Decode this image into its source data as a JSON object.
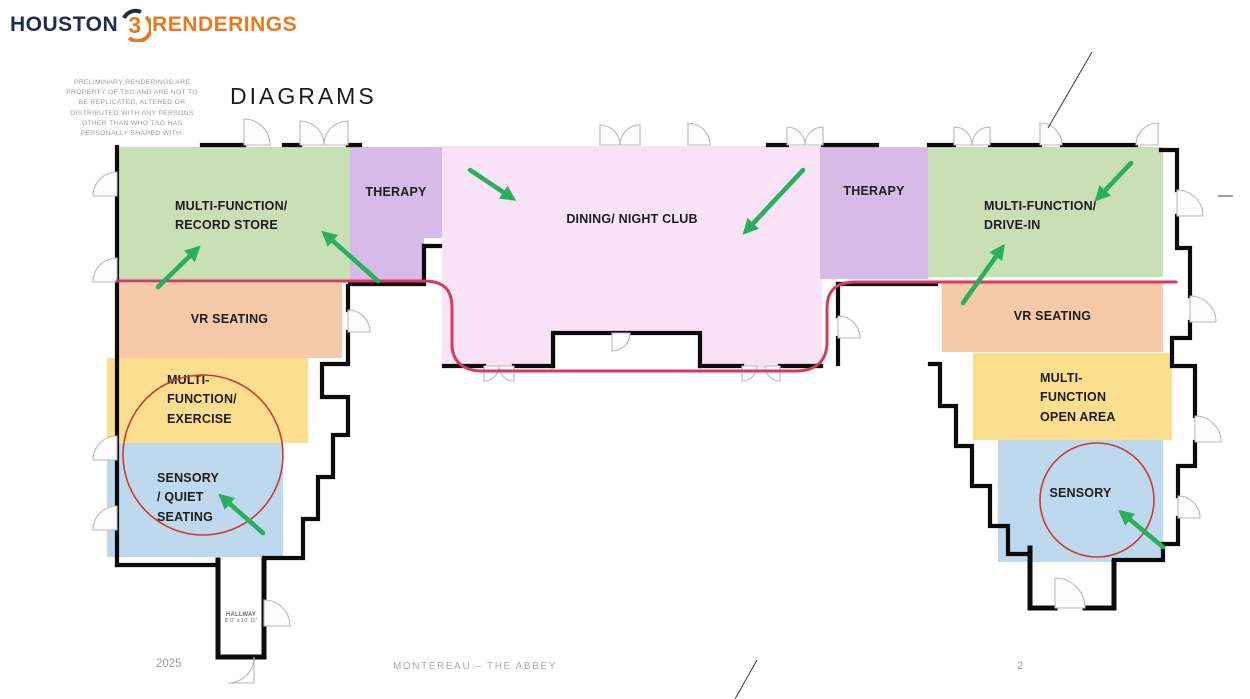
{
  "header": {
    "logo": {
      "word1": "HOUSTON",
      "digit": "3",
      "word2": "RENDERINGS",
      "navy": "#1f2c4e",
      "orange": "#e8791f"
    },
    "disclaimer": "PRELIMINARY RENDERINGS ARE\nPROPERTY OF TSG AND ARE NOT TO\nBE REPLICATED, ALTERED OR\nDISTRIBUTED WITH ANY PERSONS\nOTHER THAN WHO TSG HAS\nPERSONALLY SHARED WITH.",
    "title": "DIAGRAMS"
  },
  "zones": [
    {
      "id": "left-multifunction-record-store",
      "label": "MULTI-FUNCTION/\nRECORD STORE",
      "color": "#c9e0b6"
    },
    {
      "id": "left-therapy",
      "label": "THERAPY",
      "color": "#d6bae7"
    },
    {
      "id": "dining-night-club",
      "label": "DINING/ NIGHT CLUB",
      "color": "#f8e3f6"
    },
    {
      "id": "right-therapy",
      "label": "THERAPY",
      "color": "#d6bae7"
    },
    {
      "id": "right-multifunction-drive-in",
      "label": "MULTI-FUNCTION/\nDRIVE-IN",
      "color": "#c9e0b6"
    },
    {
      "id": "left-vr-seating",
      "label": "VR SEATING",
      "color": "#f6caa9"
    },
    {
      "id": "right-vr-seating",
      "label": "VR SEATING",
      "color": "#f6caa9"
    },
    {
      "id": "left-multifunction-exercise",
      "label": "MULTI-\nFUNCTION/\nEXERCISE",
      "color": "#fbdf8e"
    },
    {
      "id": "right-multifunction-open-area",
      "label": "MULTI-\nFUNCTION\nOPEN AREA",
      "color": "#fbdf8e"
    },
    {
      "id": "left-sensory-quiet-seating",
      "label": "SENSORY\n/ QUIET\nSEATING",
      "color": "#bed8ed"
    },
    {
      "id": "right-sensory",
      "label": "SENSORY",
      "color": "#bed8ed"
    }
  ],
  "plan": {
    "hallway_name": "HALLWAY",
    "hallway_dims": "8' 0\" x 16' 11\""
  },
  "annotations": {
    "arrow_color": "#29b05d",
    "path_color": "#d63a5c",
    "circle_color": "#cc3c30"
  },
  "footer": {
    "year": "2025",
    "project": "MONTEREAU – THE ABBEY",
    "page": "2"
  }
}
